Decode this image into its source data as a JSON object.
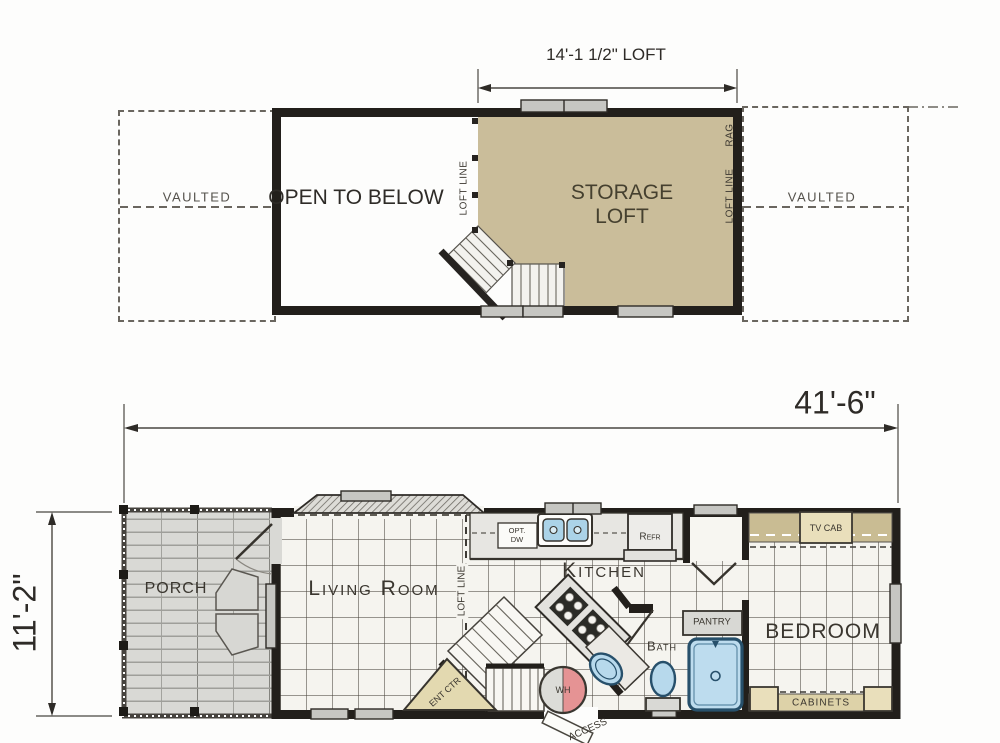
{
  "loft_plan": {
    "dim_label": "14'-1 1/2\" LOFT",
    "vaulted_left": "VAULTED",
    "vaulted_right": "VAULTED",
    "open_to_below": "OPEN TO BELOW",
    "storage_loft": "STORAGE LOFT",
    "loft_line_left": "LOFT LINE",
    "loft_line_right": "LOFT LINE",
    "rag": "RAG"
  },
  "main_plan": {
    "dim_width": "41'-6\"",
    "dim_height": "11'-2\"",
    "porch": "PORCH",
    "living_room": "Living Room",
    "kitchen": "Kitchen",
    "bedroom": "BEDROOM",
    "bath": "Bath",
    "pantry": "PANTRY",
    "loft_line": "LOFT LINE",
    "opt_dw_1": "OPT.",
    "opt_dw_2": "DW",
    "refr": "Refr",
    "tv_cab": "TV CAB",
    "cabinets": "CABINETS",
    "ent_ctr": "ENT CTR",
    "wh": "WH",
    "access": "ACCESS"
  },
  "colors": {
    "loft_floor": "#cabd9a",
    "wall": "#221f1b",
    "fixture_blue": "#b7d9ec",
    "cabinet_tan": "#ddd2a8",
    "water_heater_red": "#e59394"
  }
}
